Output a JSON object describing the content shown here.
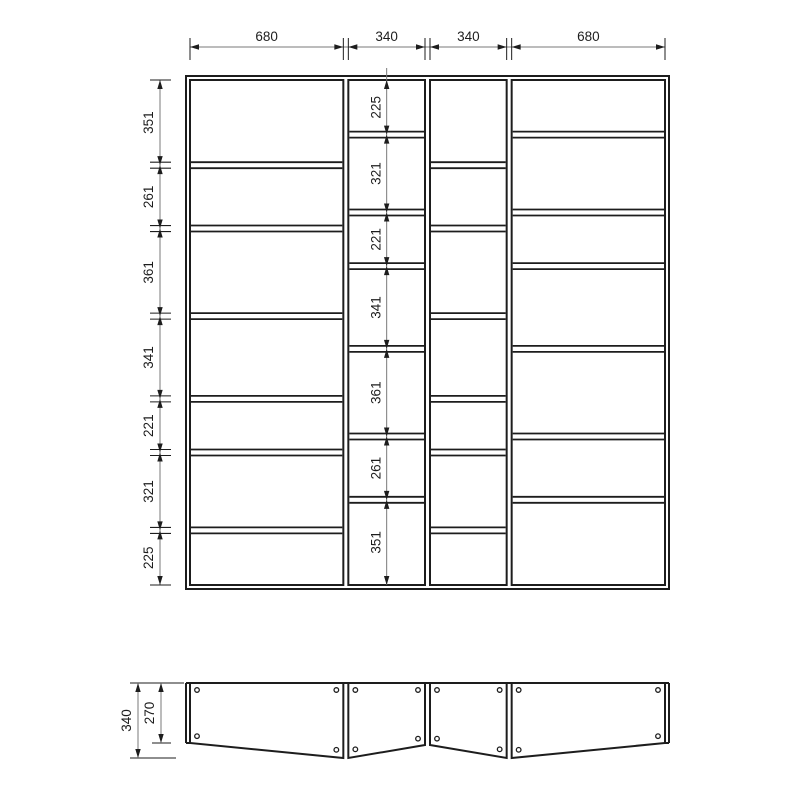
{
  "drawing_type": "furniture-technical-drawing",
  "front": {
    "column_widths": [
      680,
      340,
      340,
      680
    ],
    "columns": [
      {
        "rows": [
          351,
          261,
          361,
          341,
          221,
          321,
          225
        ]
      },
      {
        "rows": [
          225,
          321,
          221,
          341,
          361,
          261,
          351
        ]
      },
      {
        "rows": [
          351,
          261,
          361,
          341,
          221,
          321,
          225
        ]
      },
      {
        "rows": [
          225,
          321,
          221,
          341,
          361,
          261,
          351
        ]
      }
    ]
  },
  "plan": {
    "outer_depth": 340,
    "side_depth": 270,
    "panel_count": 4,
    "holes_per_panel": 4
  },
  "style": {
    "line_color": "#1d1d1d",
    "dim_line_color": "#7a7a7a",
    "background": "#ffffff"
  }
}
